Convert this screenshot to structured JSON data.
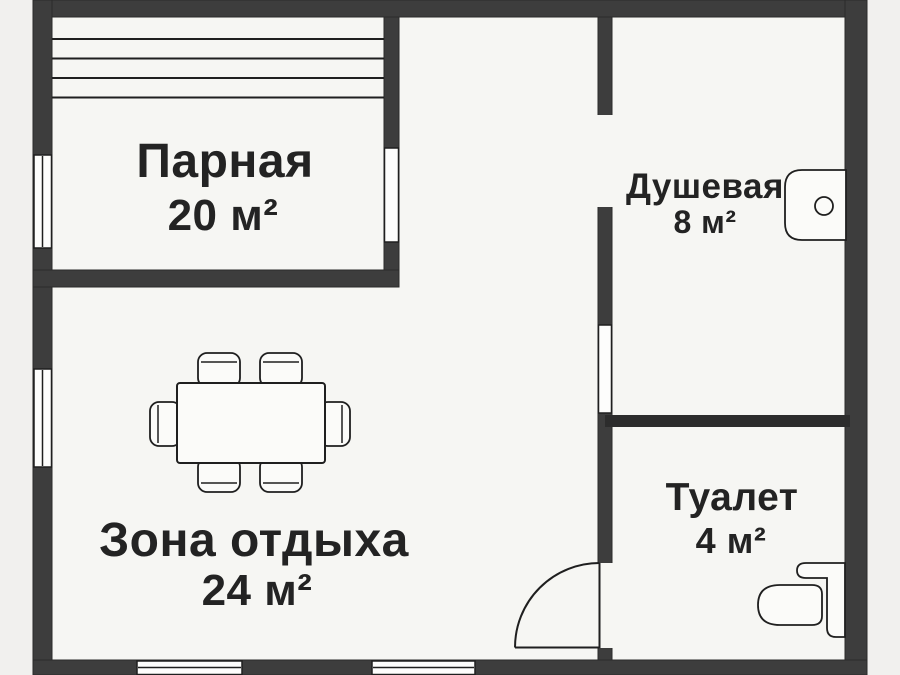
{
  "rooms": {
    "parnaya": {
      "name": "Парная",
      "area": "20 м²"
    },
    "dushevaya": {
      "name": "Душевая",
      "area": "8 м²"
    },
    "zona_otdyha": {
      "name": "Зона отдыха",
      "area": "24 м²"
    },
    "tualet": {
      "name": "Туалет",
      "area": "4 м²"
    }
  },
  "colors": {
    "outside": "#f1f0ee",
    "floor": "#f6f6f3",
    "wall": "#3d3d3d",
    "wall_dark": "#2c2c2c",
    "wall_edge": "#2a2a2a",
    "line": "#1f1f1f",
    "window_fill": "#fdfdfc",
    "fixture_fill": "#fbfbf9",
    "text": "#232323"
  },
  "fixtures": {
    "dining_table": "dining-table",
    "chairs": "chair",
    "sink": "sink",
    "toilet": "toilet",
    "door": "door-swing",
    "sauna_bench": "sauna-bench"
  }
}
